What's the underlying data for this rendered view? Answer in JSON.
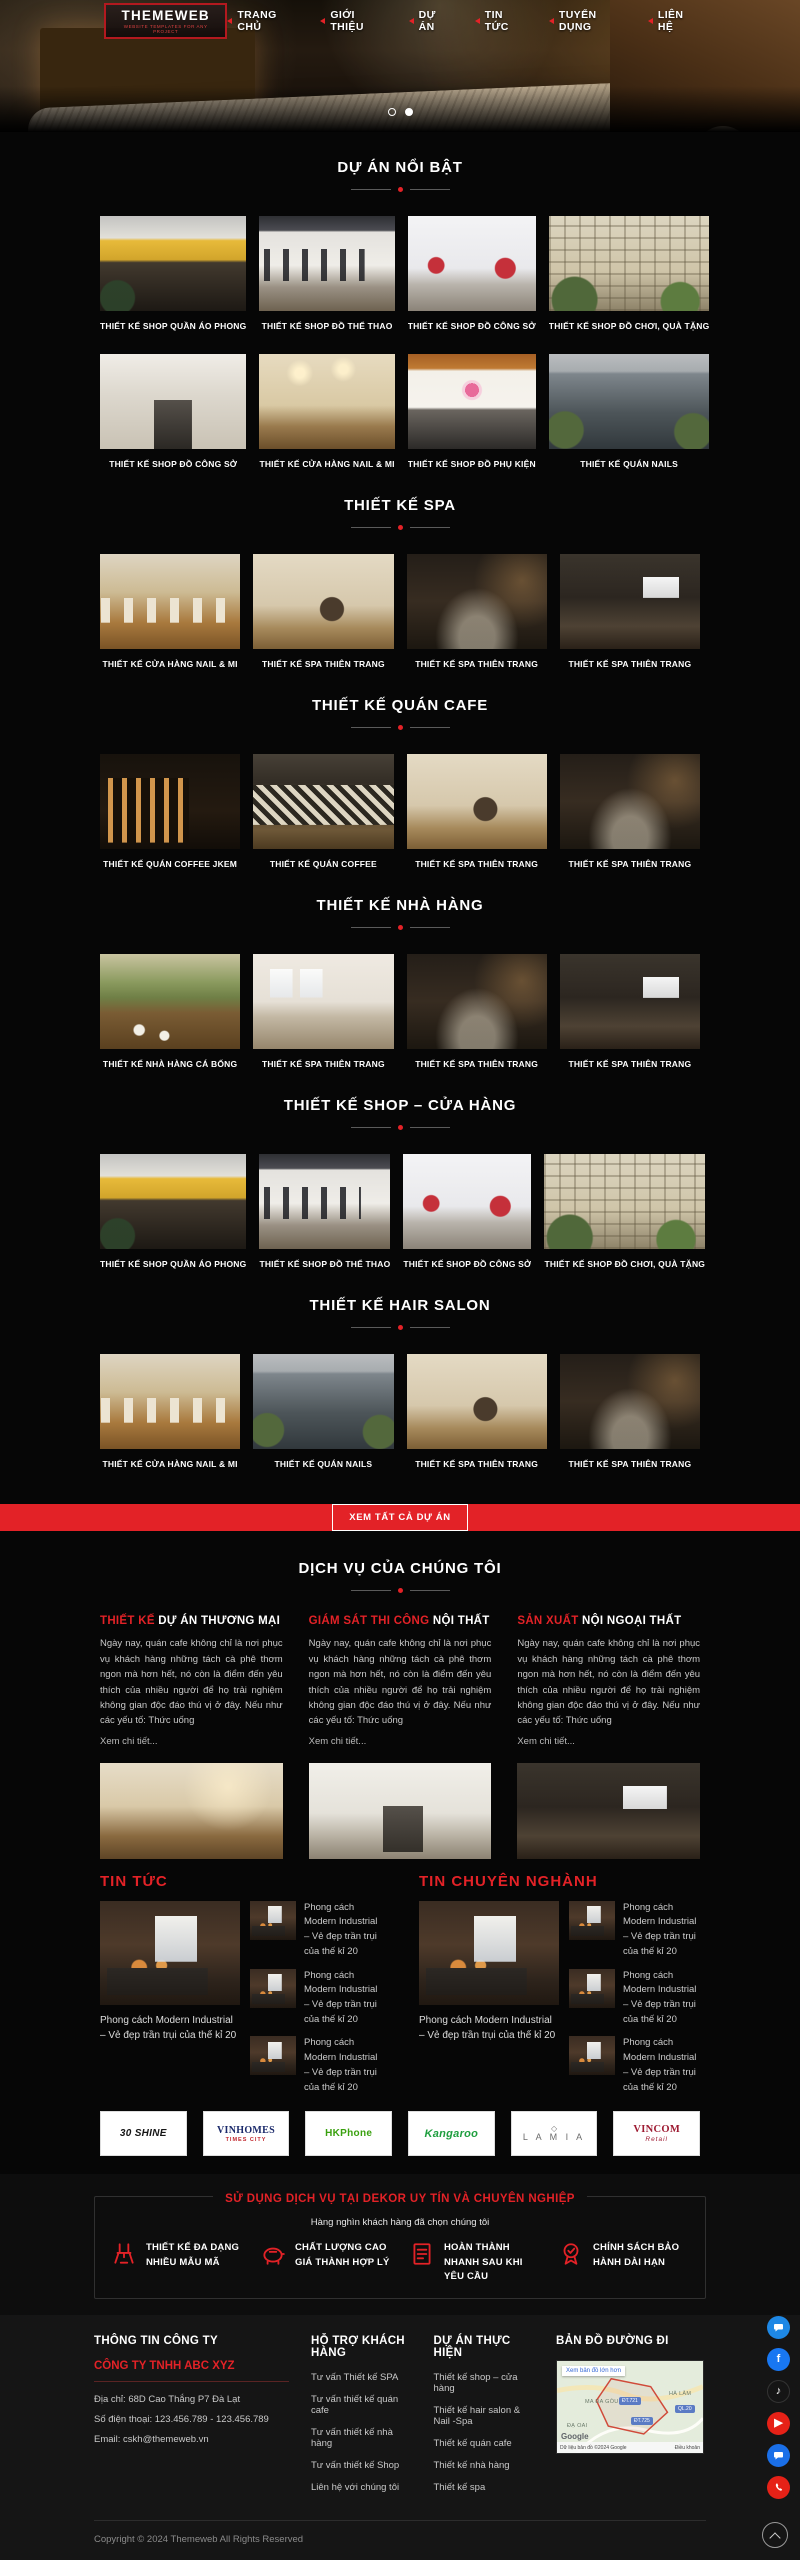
{
  "colors": {
    "accent": "#e32227",
    "page_bg": "#060606",
    "footer_bg": "#151515"
  },
  "header": {
    "logo_title": "THEMEWEB",
    "logo_subtitle": "WEBSITE TEMPLATES FOR ANY PROJECT",
    "nav": [
      "TRANG CHỦ",
      "GIỚI THIỆU",
      "DỰ ÁN",
      "TIN TỨC",
      "TUYỂN DỤNG",
      "LIÊN HỆ"
    ]
  },
  "sections": [
    {
      "title": "DỰ ÁN NỔI BẬT",
      "cards": [
        "THIẾT KẾ SHOP QUẦN ÁO PHONG",
        "THIẾT KẾ SHOP ĐỒ THỂ THAO",
        "THIẾT KẾ SHOP ĐỒ CÔNG SỞ",
        "THIẾT KẾ SHOP ĐỒ CHƠI, QUÀ TẶNG",
        "THIẾT KẾ SHOP ĐỒ CÔNG SỞ",
        "THIẾT KẾ CỬA HÀNG NAIL & MI",
        "THIẾT KẾ SHOP ĐỒ PHỤ KIỆN",
        "THIẾT KẾ QUÁN NAILS"
      ]
    },
    {
      "title": "THIẾT KẾ SPA",
      "cards": [
        "THIẾT KẾ CỬA HÀNG NAIL & MI",
        "THIẾT KẾ SPA THIÊN TRANG",
        "THIẾT KẾ SPA THIÊN TRANG",
        "THIẾT KẾ SPA THIÊN TRANG"
      ]
    },
    {
      "title": "THIẾT KẾ QUÁN CAFE",
      "cards": [
        "THIẾT KẾ QUÁN COFFEE JKEM",
        "THIẾT KẾ QUÁN COFFEE",
        "THIẾT KẾ SPA THIÊN TRANG",
        "THIẾT KẾ SPA THIÊN TRANG"
      ]
    },
    {
      "title": "THIẾT KẾ NHÀ HÀNG",
      "cards": [
        "THIẾT KẾ NHÀ HÀNG CÁ BỐNG",
        "THIẾT KẾ SPA THIÊN TRANG",
        "THIẾT KẾ SPA THIÊN TRANG",
        "THIẾT KẾ SPA THIÊN TRANG"
      ]
    },
    {
      "title": "THIẾT KẾ SHOP – CỬA HÀNG",
      "cards": [
        "THIẾT KẾ SHOP QUẦN ÁO PHONG",
        "THIẾT KẾ SHOP ĐỒ THỂ THAO",
        "THIẾT KẾ SHOP ĐỒ CÔNG SỞ",
        "THIẾT KẾ SHOP ĐỒ CHƠI, QUÀ TẶNG"
      ]
    },
    {
      "title": "THIẾT KẾ HAIR SALON",
      "cards": [
        "THIẾT KẾ CỬA HÀNG NAIL & MI",
        "THIẾT KẾ QUÁN NAILS",
        "THIẾT KẾ SPA THIÊN TRANG",
        "THIẾT KẾ SPA THIÊN TRANG"
      ]
    }
  ],
  "cta": {
    "label": "XEM TẤT CẢ DỰ ÁN"
  },
  "services": {
    "title": "DỊCH VỤ CỦA CHÚNG TÔI",
    "body": "Ngày nay, quán cafe không chỉ là nơi phục vụ khách hàng những tách cà phê thơm ngon mà hơn hết, nó còn là điểm đến yêu thích của nhiều người để họ trải nghiệm không gian độc đáo thú vị ở đây. Nếu như các yếu tố: Thức uống",
    "more": "Xem chi tiết...",
    "items": [
      {
        "title_red": "THIẾT KẾ ",
        "title_rest": "DỰ ÁN THƯƠNG MẠI"
      },
      {
        "title_red": "GIÁM SÁT THI CÔNG ",
        "title_rest": "NỘI THẤT"
      },
      {
        "title_red": "SẢN XUẤT ",
        "title_rest": "NỘI NGOẠI THẤT"
      }
    ]
  },
  "news": [
    {
      "title": "TIN TỨC",
      "featured_caption": "Phong cách Modern Industrial – Vẻ đẹp trần trụi của thế kỉ 20",
      "items": [
        "Phong cách Modern Industrial – Vẻ đẹp trần trụi của thế kỉ 20",
        "Phong cách Modern Industrial – Vẻ đẹp trần trụi của thế kỉ 20",
        "Phong cách Modern Industrial – Vẻ đẹp trần trụi của thế kỉ 20"
      ]
    },
    {
      "title": "TIN CHUYÊN NGHÀNH",
      "featured_caption": "Phong cách Modern Industrial – Vẻ đẹp trần trụi của thế kỉ 20",
      "items": [
        "Phong cách Modern Industrial – Vẻ đẹp trần trụi của thế kỉ 20",
        "Phong cách Modern Industrial – Vẻ đẹp trần trụi của thế kỉ 20",
        "Phong cách Modern Industrial – Vẻ đẹp trần trụi của thế kỉ 20"
      ]
    }
  ],
  "brands": [
    {
      "name": "30 SHINE",
      "sub": ""
    },
    {
      "name": "VINHOMES",
      "sub": "TIMES CITY"
    },
    {
      "name": "HKPhone",
      "sub": ""
    },
    {
      "name": "Kangaroo",
      "sub": ""
    },
    {
      "name": "L A M I A",
      "sub": "",
      "mark": "◇"
    },
    {
      "name": "VINCOM",
      "sub": "Retail"
    }
  ],
  "features": {
    "title": "SỬ DỤNG DỊCH VỤ TẠI DEKOR UY TÍN VÀ CHUYÊN NGHIỆP",
    "subtitle": "Hàng nghìn khách hàng đã chọn chúng tôi",
    "items": [
      {
        "icon": "chair-icon",
        "label": "THIẾT KẾ ĐA DẠNG NHIỀU MẪU MÃ"
      },
      {
        "icon": "piggy-bank-icon",
        "label": "CHẤT LƯỢNG CAO GIÁ THÀNH HỢP LÝ"
      },
      {
        "icon": "order-list-icon",
        "label": "HOÀN THÀNH NHANH SAU KHI YÊU CẦU"
      },
      {
        "icon": "warranty-ribbon-icon",
        "label": "CHÍNH SÁCH BẢO HÀNH DÀI HẠN"
      }
    ]
  },
  "footer": {
    "company": {
      "title": "THÔNG TIN CÔNG TY",
      "name": "CÔNG TY TNHH ABC XYZ",
      "address": "Địa chỉ: 68D Cao Thắng P7 Đà Lạt",
      "phone": "Số điện thoại: 123.456.789 - 123.456.789",
      "email": "Email: cskh@themeweb.vn"
    },
    "support": {
      "title": "HỖ TRỢ KHÁCH HÀNG",
      "links": [
        "Tư vấn Thiết kế SPA",
        "Tư vấn thiết kế quán cafe",
        "Tư vấn thiết kế nhà hàng",
        "Tư vấn thiết kế Shop",
        "Liên hệ với chúng tôi"
      ]
    },
    "projects": {
      "title": "DỰ ÁN THỰC HIỆN",
      "links": [
        "Thiết kế shop – cửa hàng",
        "Thiết kế hair salon & Nail -Spa",
        "Thiết kế quán cafe",
        "Thiết kế nhà hàng",
        "Thiết kế spa"
      ]
    },
    "map": {
      "title": "BẢN ĐỒ ĐƯỜNG ĐI",
      "button": "Xem bản đồ lớn hơn",
      "google": "Google",
      "attribution": "Dữ liệu bản đồ ©2024 Google",
      "terms": "Điều khoản",
      "labels": [
        "MA ĐA GÒU",
        "HÀ LÂM",
        "ĐẠ OAI"
      ],
      "badges": [
        "ĐT.721",
        "ĐT.725",
        "QL.20"
      ]
    },
    "copyright": "Copyright © 2024 Themeweb All Rights Reserved"
  }
}
